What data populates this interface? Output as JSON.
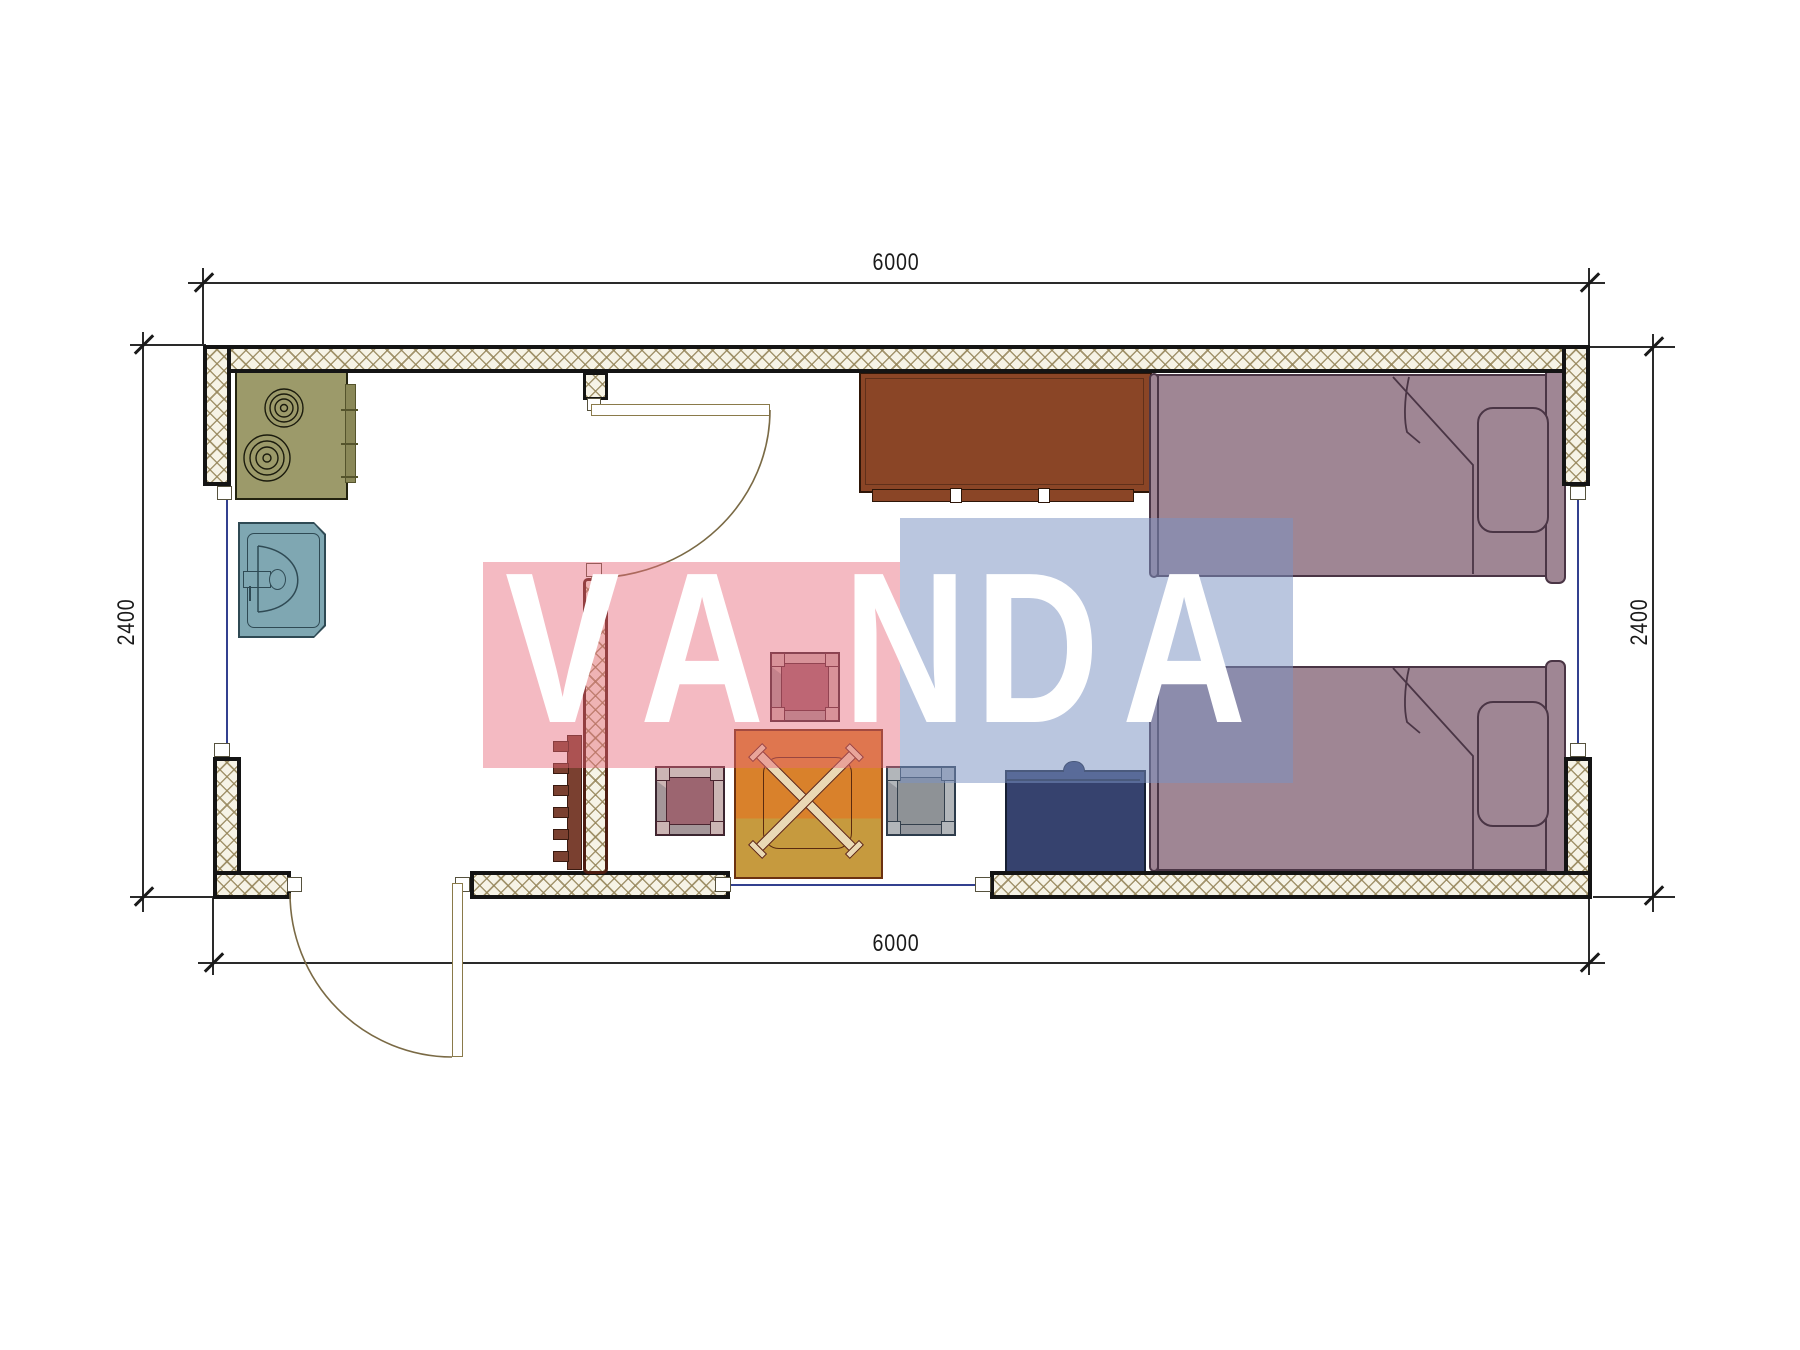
{
  "drawing": {
    "type": "floor-plan",
    "dimensions": {
      "top": "6000",
      "bottom": "6000",
      "left": "2400",
      "right": "2400"
    },
    "watermark": {
      "text": "VANDA",
      "letters": [
        "V",
        "A",
        "N",
        "D",
        "A"
      ],
      "pink_color": "#e8697a",
      "blue_color": "#7a92c2",
      "text_color": "#ffffff"
    },
    "furniture": [
      {
        "name": "stove"
      },
      {
        "name": "sink"
      },
      {
        "name": "interior-door"
      },
      {
        "name": "entry-door"
      },
      {
        "name": "coat-hooks"
      },
      {
        "name": "table-with-folding-legs"
      },
      {
        "name": "stool-upper"
      },
      {
        "name": "stool-left"
      },
      {
        "name": "stool-right"
      },
      {
        "name": "chest"
      },
      {
        "name": "wardrobe"
      },
      {
        "name": "bed-upper"
      },
      {
        "name": "bed-lower"
      }
    ],
    "colors": {
      "wall_hatch_bg": "#f6f3e6",
      "wall_line": "#141414",
      "partition_line": "#4d1d12",
      "stove": "#9c9a6a",
      "sink": "#7fa7b2",
      "wardrobe": "#8a4526",
      "bed": "#9f8694",
      "table_top": "#d9812b",
      "table_bottom": "#c69a3e",
      "stool_mauve": "#9c6570",
      "stool_gray": "#8e9296",
      "chest": "#36426e",
      "window_line": "#33408f",
      "door_arc": "#7a6a45"
    }
  }
}
